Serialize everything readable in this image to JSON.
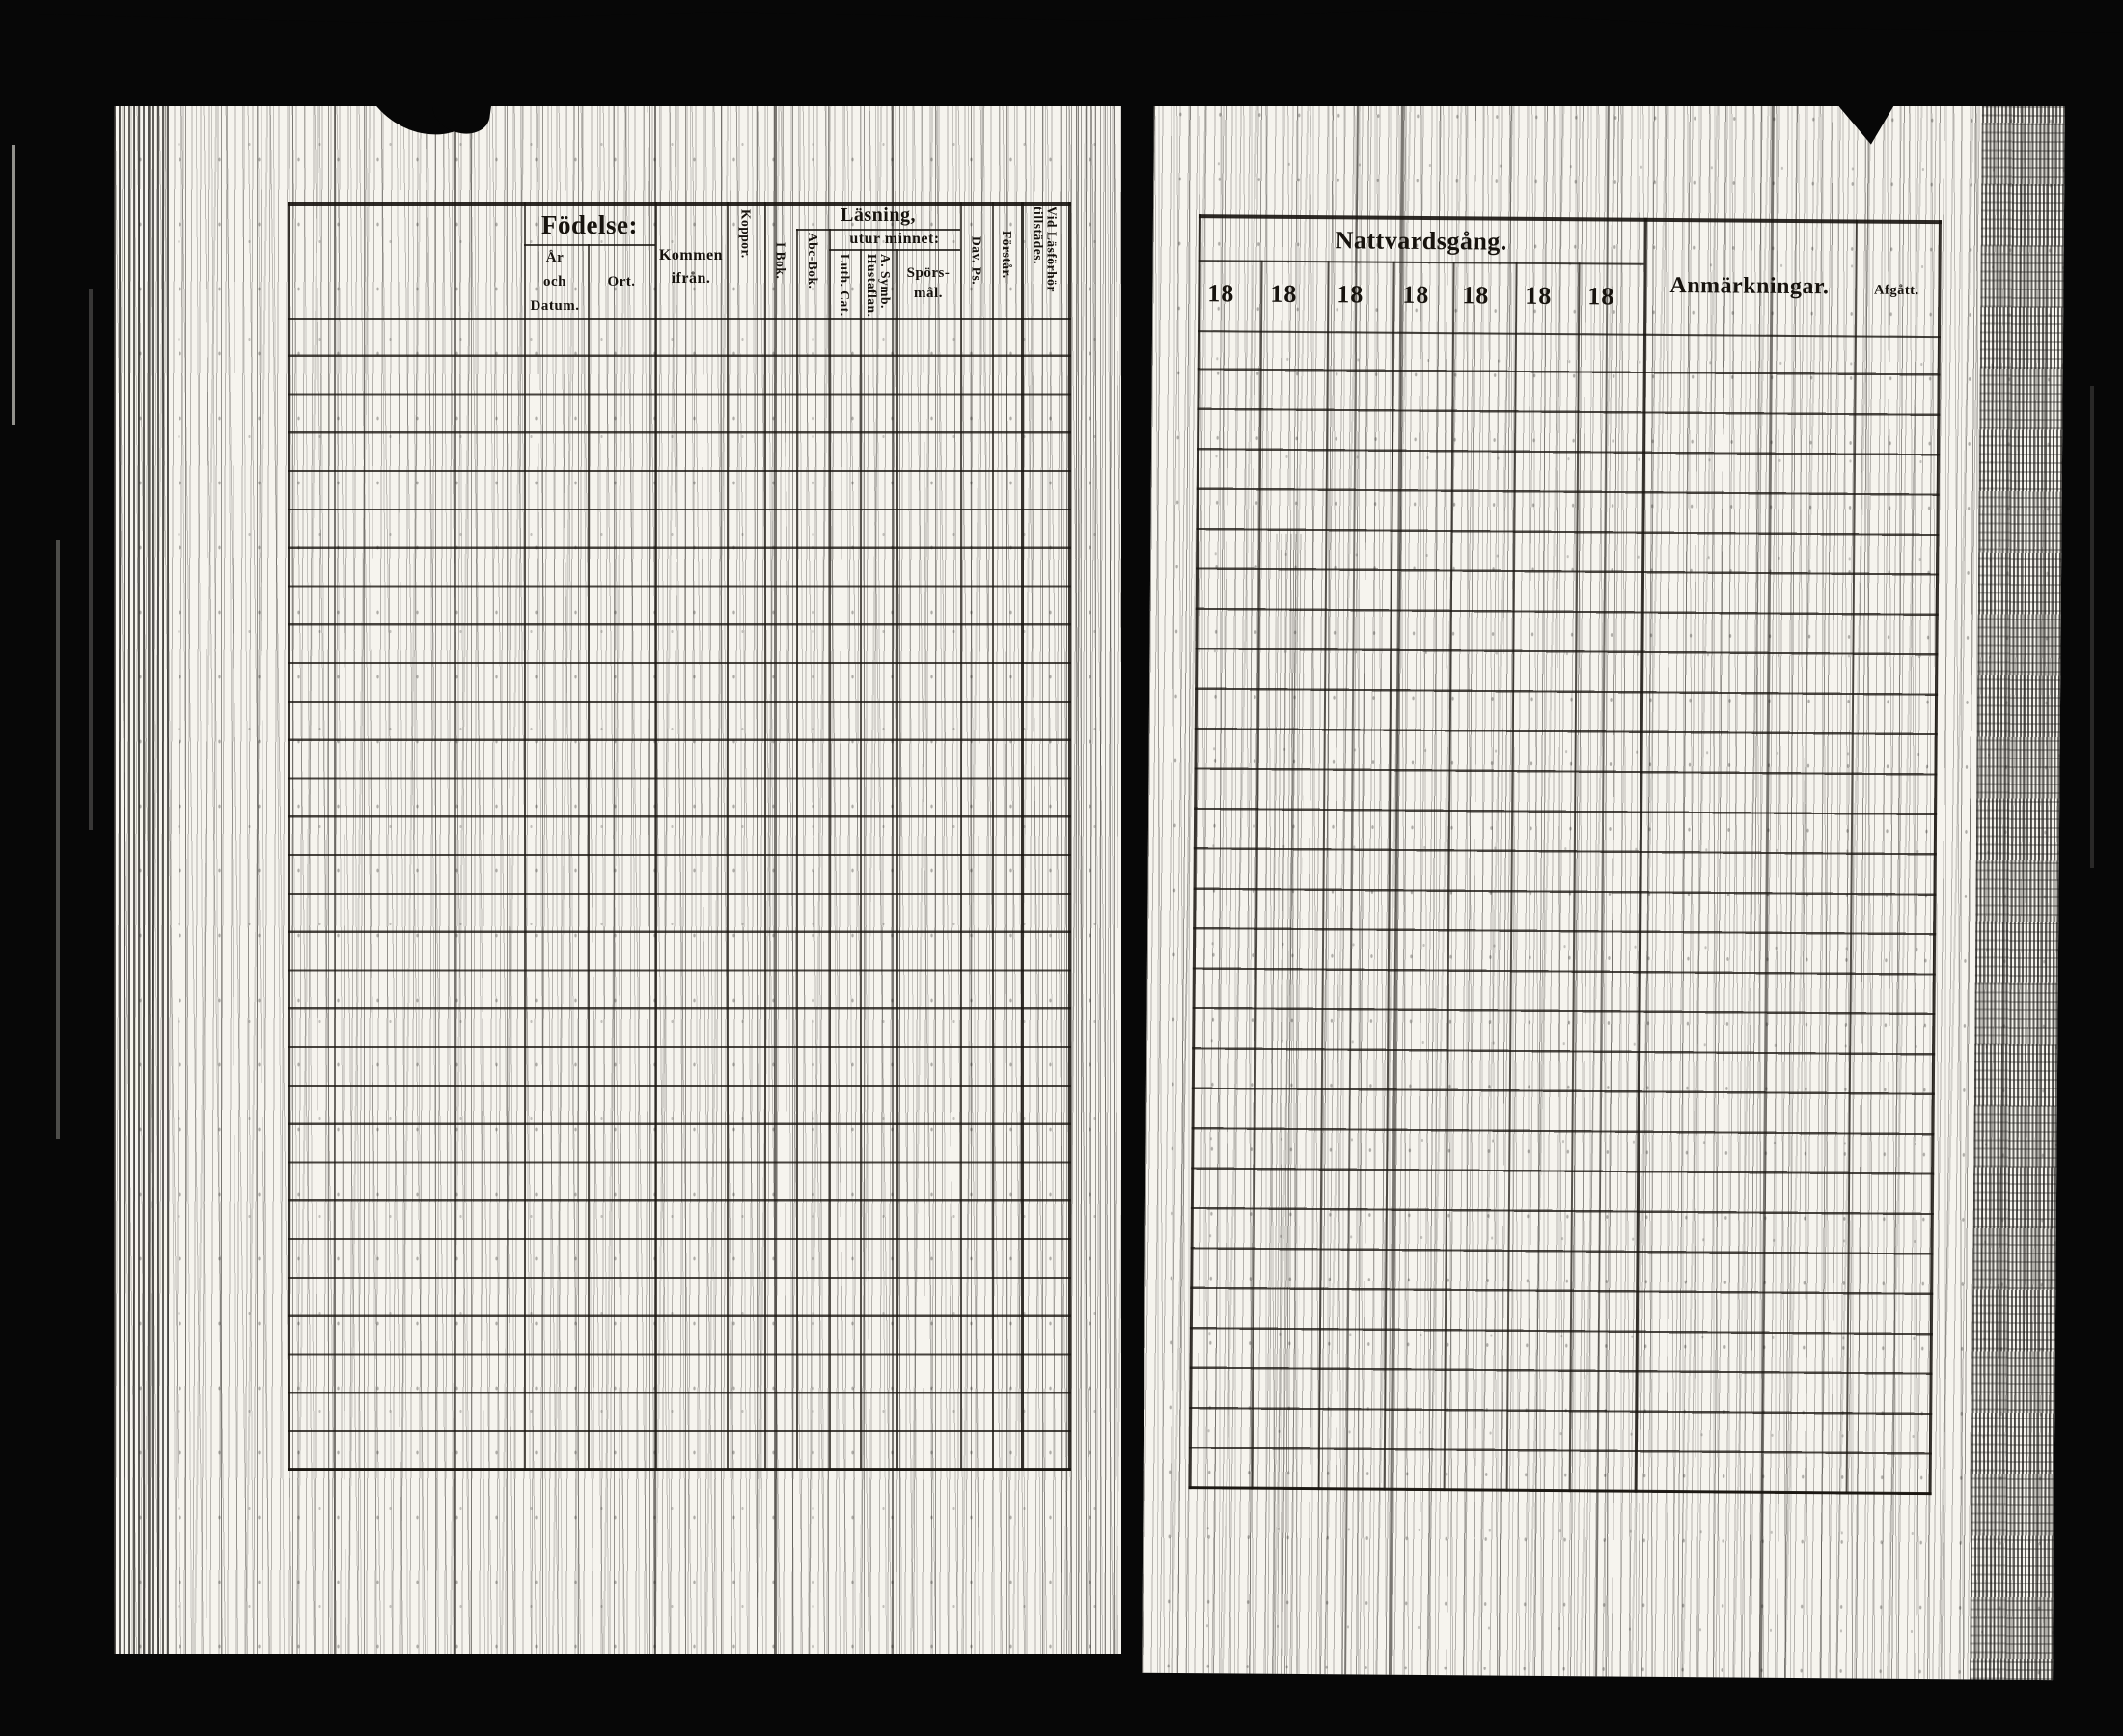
{
  "left_table": {
    "fodelse": {
      "label": "Födelse:",
      "ar_och_datum": [
        "År",
        "och",
        "Datum."
      ],
      "ort": "Ort."
    },
    "kommen": [
      "Kommen",
      "ifrån."
    ],
    "koppor": "Koppor.",
    "i_bok": "I Bok.",
    "lasning": "Läsning,",
    "abc_bok": "Abc-Bok.",
    "utur_minnet": "utur minnet:",
    "luth_cat": "Luth. Cat.",
    "a_symb": [
      "A. Symb.",
      "Hustaflan."
    ],
    "sporsmal": [
      "Spörs-",
      "mål."
    ],
    "dav_ps": "Dav. Ps.",
    "forstar": "Förstår.",
    "vid_lasforhor": [
      "Vid Läsförhör",
      "tillstädes."
    ],
    "data_row_count": 30
  },
  "right_table": {
    "nattvardsgang": "Nattvardsgång.",
    "year_columns": [
      "18",
      "18",
      "18",
      "18",
      "18",
      "18",
      "18"
    ],
    "anmarkningar": "Anmärkningar.",
    "afgatt": "Afgått.",
    "data_row_count": 29
  },
  "colors": {
    "film_background": "#070707",
    "paper": "#f6f4ee",
    "ink": "#17130e"
  }
}
